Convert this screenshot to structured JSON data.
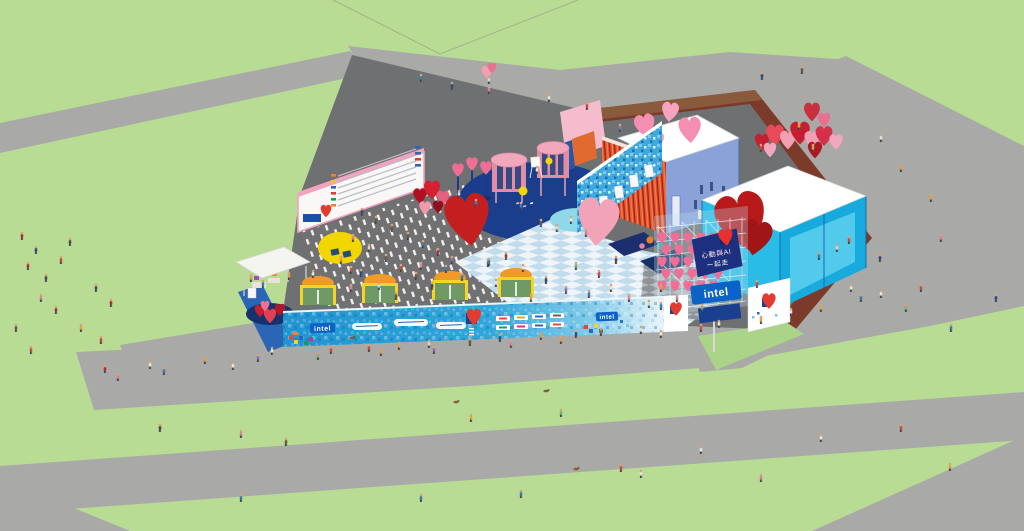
{
  "branding": {
    "intel": "intel",
    "scaffold_sign_line1": "心動與AI",
    "scaffold_sign_line2": "一起走"
  },
  "colors": {
    "grass": "#b9dc95",
    "path_gray": "#a9a9a7",
    "venue_ground": "#6f7072",
    "maroon_path": "#7c3a2a",
    "brown_strip": "#8a5a3c",
    "banner_blue": "#2a9fd6",
    "intel_blue": "#0b62c7",
    "sign_navy": "#1d2f7f",
    "checker_light": "#eef4f7",
    "checker_blue": "#c2dcec",
    "stage_navy": "#1a3e8c",
    "canopy_cyan": "#28bce6",
    "heart_red": "#c41f1f",
    "heart_pink": "#f48fb1",
    "streamer_red": "#d8432a",
    "booth_green": "#6f9a66",
    "booth_orange": "#f09a28",
    "sculpture_yellow": "#f2d600"
  }
}
